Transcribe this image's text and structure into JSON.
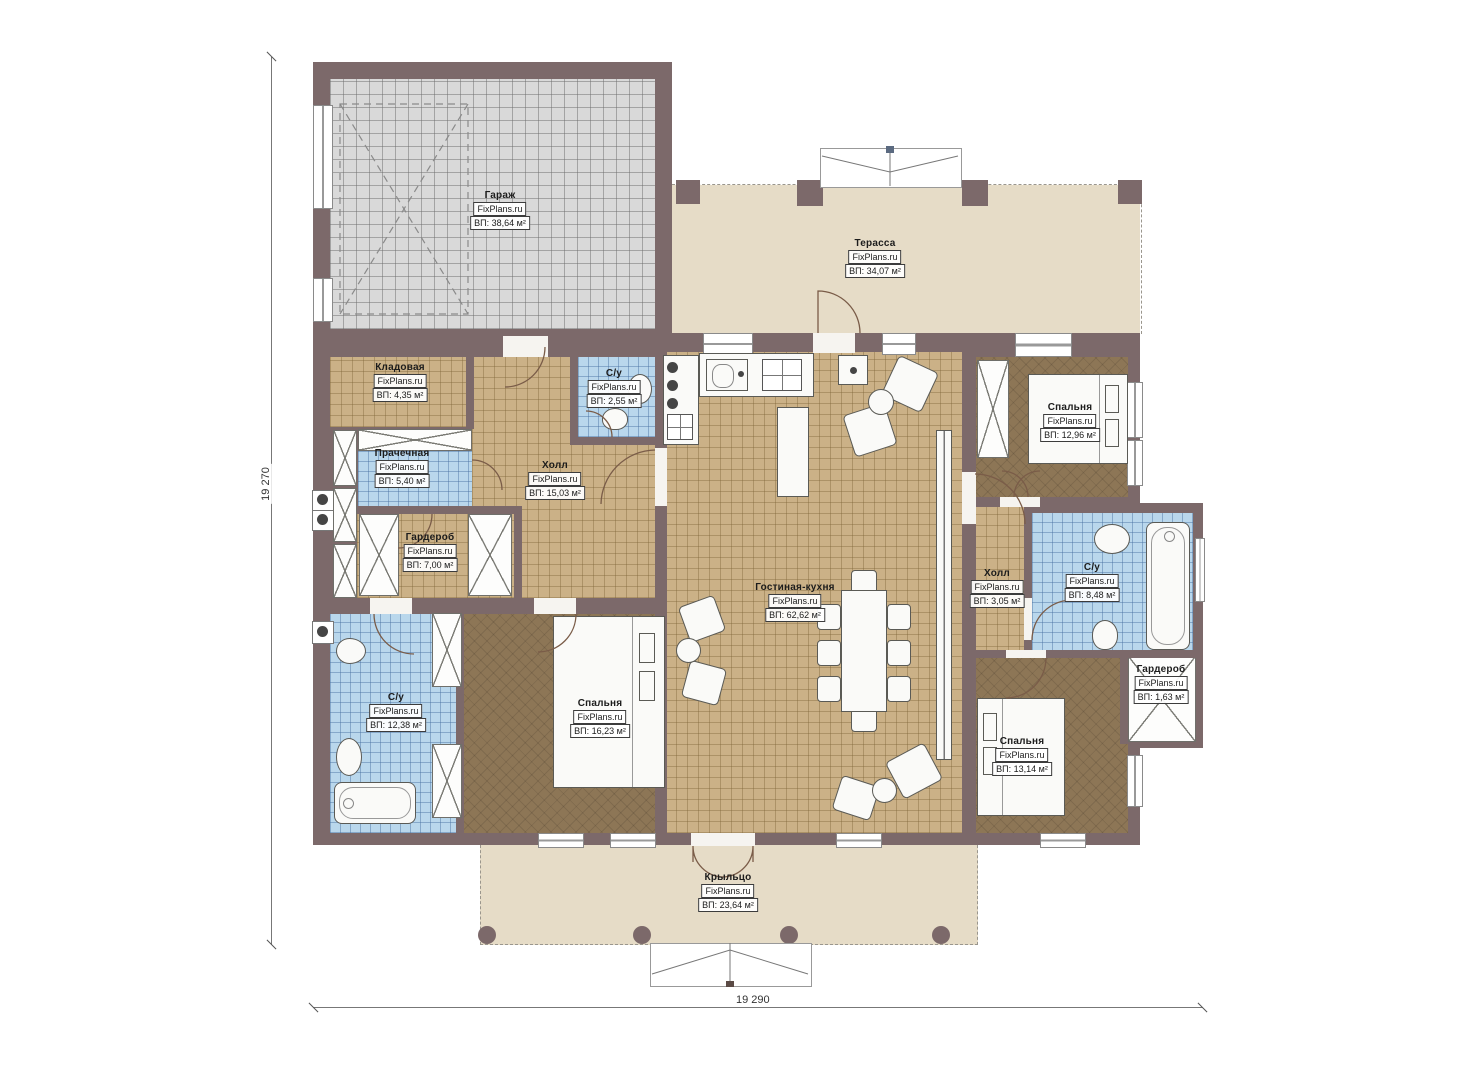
{
  "dimensions": {
    "left": "19 270",
    "bottom": "19 290"
  },
  "brand": "FixPlans.ru",
  "rooms": [
    {
      "id": "garage",
      "name": "Гараж",
      "brand": "FixPlans.ru",
      "area": "ВП: 38,64 м²"
    },
    {
      "id": "terrace",
      "name": "Терасса",
      "brand": "FixPlans.ru",
      "area": "ВП: 34,07 м²"
    },
    {
      "id": "pantry",
      "name": "Кладовая",
      "brand": "FixPlans.ru",
      "area": "ВП: 4,35 м²"
    },
    {
      "id": "wc-top",
      "name": "С/у",
      "brand": "FixPlans.ru",
      "area": "ВП: 2,55 м²"
    },
    {
      "id": "laundry",
      "name": "Прачечная",
      "brand": "FixPlans.ru",
      "area": "ВП: 5,40 м²"
    },
    {
      "id": "hall-main",
      "name": "Холл",
      "brand": "FixPlans.ru",
      "area": "ВП: 15,03 м²"
    },
    {
      "id": "wardrobe-left",
      "name": "Гардероб",
      "brand": "FixPlans.ru",
      "area": "ВП: 7,00 м²"
    },
    {
      "id": "wc-left",
      "name": "С/у",
      "brand": "FixPlans.ru",
      "area": "ВП: 12,38 м²"
    },
    {
      "id": "bedroom-left",
      "name": "Спальня",
      "brand": "FixPlans.ru",
      "area": "ВП: 16,23 м²"
    },
    {
      "id": "living-kitchen",
      "name": "Гостиная-кухня",
      "brand": "FixPlans.ru",
      "area": "ВП: 62,62 м²"
    },
    {
      "id": "bedroom-top-right",
      "name": "Спальня",
      "brand": "FixPlans.ru",
      "area": "ВП: 12,96 м²"
    },
    {
      "id": "hall-right",
      "name": "Холл",
      "brand": "FixPlans.ru",
      "area": "ВП: 3,05 м²"
    },
    {
      "id": "wc-right",
      "name": "С/у",
      "brand": "FixPlans.ru",
      "area": "ВП: 8,48 м²"
    },
    {
      "id": "wardrobe-right",
      "name": "Гардероб",
      "brand": "FixPlans.ru",
      "area": "ВП: 1,63 м²"
    },
    {
      "id": "bedroom-bottom-right",
      "name": "Спальня",
      "brand": "FixPlans.ru",
      "area": "ВП: 13,14 м²"
    },
    {
      "id": "porch",
      "name": "Крыльцо",
      "brand": "FixPlans.ru",
      "area": "ВП: 23,64 м²"
    }
  ],
  "colors": {
    "wall": "#7c696a",
    "floor_tan": "#cbb187",
    "floor_brown": "#8d7656",
    "tile_blue": "#b9d7ec",
    "outdoor_beige": "#e6dcc7",
    "garage_gray": "#d9d9d9",
    "fixture_white": "#fafaf8"
  }
}
